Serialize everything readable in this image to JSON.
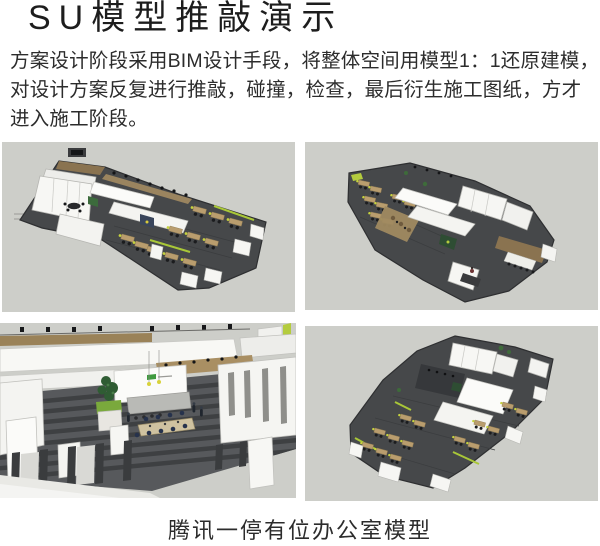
{
  "header": {
    "title": "SU模型推敲演示"
  },
  "intro": {
    "lines": [
      "方案设计阶段采用BIM设计手段，将整体空间用模型1：1还原建模，",
      "对设计方案反复进行推敲，碰撞，检查，最后衍生施工图纸，方才",
      "进入施工阶段。"
    ]
  },
  "gallery": {
    "images": [
      {
        "name": "su-office-model-aerial-view-1"
      },
      {
        "name": "su-office-model-aerial-view-2"
      },
      {
        "name": "su-office-model-interior-reception-view"
      },
      {
        "name": "su-office-model-aerial-view-3"
      }
    ]
  },
  "footer": {
    "caption": "腾讯一停有位办公室模型"
  },
  "colors": {
    "panel_background": "#cdcec9",
    "floor_dark": "#46484a",
    "wall_white": "#f6f6f3",
    "wood": "#b99d6e",
    "accent_lime": "#b4cc3e",
    "plant_green": "#3e6b3a",
    "text": "#2c2c2c"
  }
}
